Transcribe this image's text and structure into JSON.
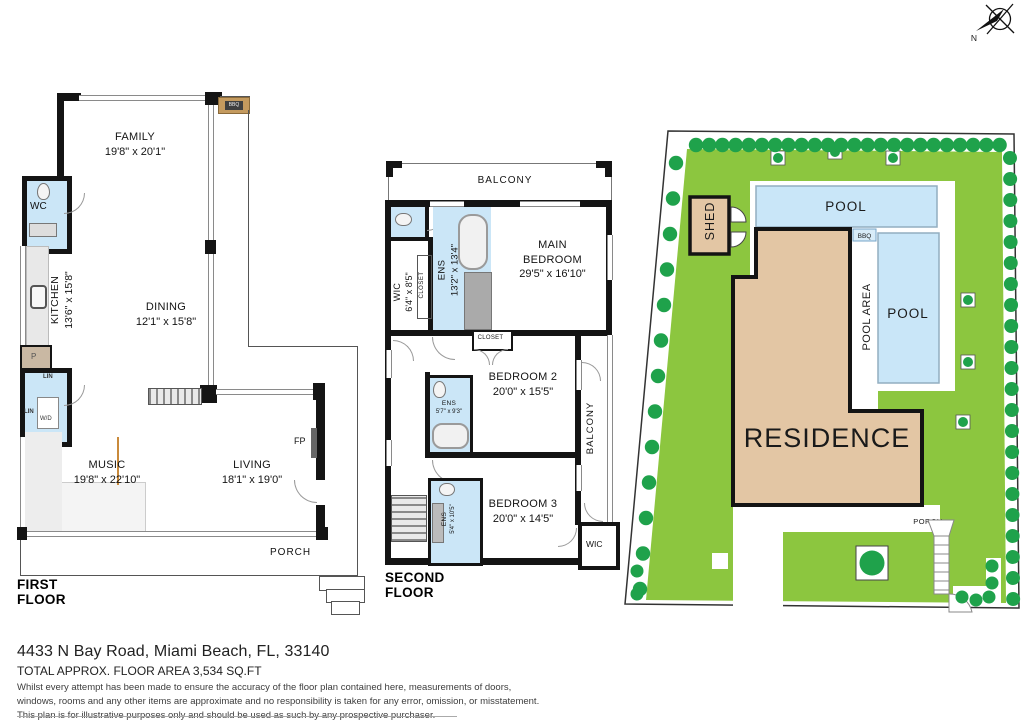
{
  "colors": {
    "lawn": "#8cc63f",
    "tree": "#1fa24b",
    "pool": "#c9e6f8",
    "building": "#e3c6a4",
    "bathroom": "#cbe6f7",
    "wall": "#141414"
  },
  "compass": {
    "label": "N"
  },
  "first_floor": {
    "title": "FIRST FLOOR",
    "rooms": {
      "family": {
        "name": "FAMILY",
        "dims": "19'8\" x 20'1\""
      },
      "kitchen": {
        "name": "KITCHEN",
        "dims": "13'6\" x 15'8\""
      },
      "dining": {
        "name": "DINING",
        "dims": "12'1\" x 15'8\""
      },
      "music": {
        "name": "MUSIC",
        "dims": "19'8\" x 22'10\""
      },
      "living": {
        "name": "LIVING",
        "dims": "18'1\" x 19'0\""
      }
    },
    "labels": {
      "wc": "WC",
      "pantry": "P",
      "linen_top": "LIN",
      "linen_side": "LIN",
      "washer_dryer": "W/D",
      "fireplace": "FP",
      "bbq": "BBQ",
      "porch": "PORCH"
    }
  },
  "second_floor": {
    "title": "SECOND FLOOR",
    "rooms": {
      "balcony_top": {
        "name": "BALCONY"
      },
      "wic": {
        "name": "WIC",
        "dims": "6'4\" x 8'5\""
      },
      "closet_wic": {
        "name": "CLOSET"
      },
      "ens_main": {
        "name": "ENS",
        "dims": "13'2\" x 13'4\""
      },
      "main_bedroom": {
        "line1": "MAIN",
        "line2": "BEDROOM",
        "dims": "29'5\" x 16'10\""
      },
      "closet_hall": {
        "name": "CLOSET"
      },
      "bedroom2": {
        "name": "BEDROOM 2",
        "dims": "20'0\" x 15'5\""
      },
      "ens2": {
        "name": "ENS",
        "dims": "5'7\" x 9'3\""
      },
      "balcony_right": {
        "name": "BALCONY"
      },
      "bedroom3": {
        "name": "BEDROOM 3",
        "dims": "20'0\" x 14'5\""
      },
      "ens3": {
        "name": "ENS",
        "dims": "5'4\" x 10'5\""
      },
      "wic_rear": {
        "name": "WIC"
      }
    }
  },
  "site_plan": {
    "shed": "SHED",
    "pool_top": "POOL",
    "pool_right": "POOL",
    "pool_area": "POOL AREA",
    "bbq": "BBQ",
    "residence": "RESIDENCE",
    "porch": "PORCH"
  },
  "footer": {
    "address": "4433 N Bay Road, Miami Beach, FL, 33140",
    "area": "TOTAL APPROX. FLOOR AREA 3,534 SQ.FT",
    "disclaimer_line1": "Whilst every attempt has been made to ensure the accuracy of the floor plan contained here, measurements of doors,",
    "disclaimer_line2": "windows, rooms and any other items are approximate and no responsibility is taken for any error, omission, or misstatement.",
    "disclaimer_line3": "This plan is for illustrative purposes only and should be used as such by any prospective purchaser."
  }
}
